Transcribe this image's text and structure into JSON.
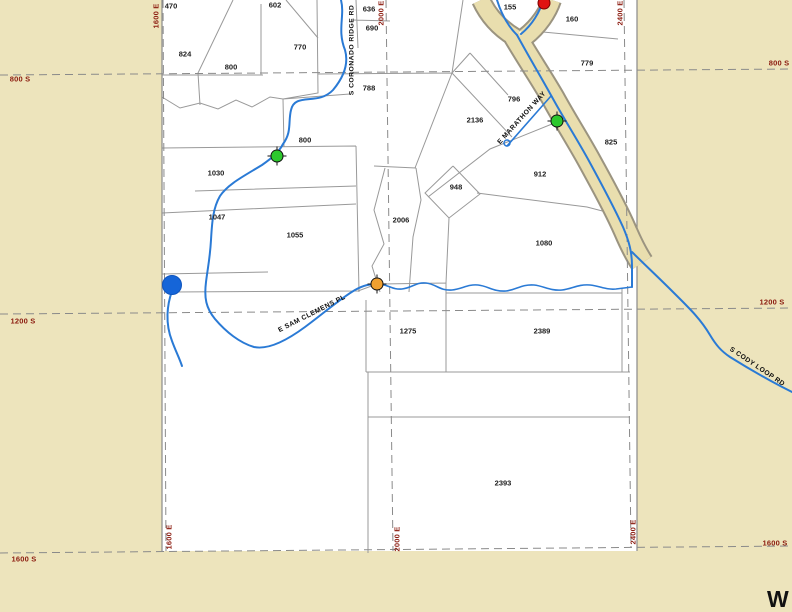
{
  "map": {
    "colors": {
      "background_tan": "#EDE4BC",
      "parcel_area_white": "#FFFFFF",
      "grid_label_red": "#8B1A0E",
      "stream_blue": "#2A7AD5",
      "road_fill_tan": "#E9DEAE",
      "road_casing_gray": "#9B9480",
      "parcel_line_gray": "#999999"
    },
    "compass": {
      "label": "W"
    },
    "grid_labels": [
      {
        "text": "1600 E",
        "x": 156,
        "y": 16,
        "rot": -90,
        "edge": "top"
      },
      {
        "text": "2000 E",
        "x": 381,
        "y": 13,
        "rot": -90,
        "edge": "top"
      },
      {
        "text": "2400 E",
        "x": 620,
        "y": 13,
        "rot": -90,
        "edge": "top"
      },
      {
        "text": "1600 E",
        "x": 169,
        "y": 537,
        "rot": -90,
        "edge": "bottom"
      },
      {
        "text": "2000 E",
        "x": 397,
        "y": 539,
        "rot": -90,
        "edge": "bottom"
      },
      {
        "text": "2400 E",
        "x": 633,
        "y": 532,
        "rot": -90,
        "edge": "bottom"
      },
      {
        "text": "800 S",
        "x": 20,
        "y": 79,
        "rot": 0,
        "edge": "left"
      },
      {
        "text": "1200 S",
        "x": 23,
        "y": 321,
        "rot": 0,
        "edge": "left"
      },
      {
        "text": "1600 S",
        "x": 24,
        "y": 559,
        "rot": 0,
        "edge": "left"
      },
      {
        "text": "800 S",
        "x": 779,
        "y": 63,
        "rot": 0,
        "edge": "right"
      },
      {
        "text": "1200 S",
        "x": 772,
        "y": 302,
        "rot": 0,
        "edge": "right"
      },
      {
        "text": "1600 S",
        "x": 775,
        "y": 543,
        "rot": 0,
        "edge": "right"
      }
    ],
    "road_labels": [
      {
        "text": "S CORONADO RIDGE RD",
        "x": 352,
        "y": 50,
        "rot": -90
      },
      {
        "text": "E MARATHON WAY",
        "x": 522,
        "y": 118,
        "rot": -48
      },
      {
        "text": "E SAM CLEMENS PL",
        "x": 312,
        "y": 314,
        "rot": -27
      },
      {
        "text": "S CODY LOOP RD",
        "x": 757,
        "y": 367,
        "rot": 34
      }
    ],
    "parcels": [
      {
        "label": "470",
        "x": 171,
        "y": 6
      },
      {
        "label": "602",
        "x": 275,
        "y": 5
      },
      {
        "label": "636",
        "x": 369,
        "y": 9
      },
      {
        "label": "690",
        "x": 372,
        "y": 28
      },
      {
        "label": "770",
        "x": 300,
        "y": 47
      },
      {
        "label": "824",
        "x": 185,
        "y": 54
      },
      {
        "label": "800",
        "x": 231,
        "y": 67
      },
      {
        "label": "788",
        "x": 369,
        "y": 88
      },
      {
        "label": "155",
        "x": 510,
        "y": 7
      },
      {
        "label": "160",
        "x": 572,
        "y": 19
      },
      {
        "label": "779",
        "x": 587,
        "y": 63
      },
      {
        "label": "796",
        "x": 514,
        "y": 99
      },
      {
        "label": "2136",
        "x": 475,
        "y": 120
      },
      {
        "label": "825",
        "x": 611,
        "y": 142
      },
      {
        "label": "800",
        "x": 305,
        "y": 140
      },
      {
        "label": "1030",
        "x": 216,
        "y": 173
      },
      {
        "label": "912",
        "x": 540,
        "y": 174
      },
      {
        "label": "948",
        "x": 456,
        "y": 187
      },
      {
        "label": "1047",
        "x": 217,
        "y": 217
      },
      {
        "label": "2006",
        "x": 401,
        "y": 220
      },
      {
        "label": "1055",
        "x": 295,
        "y": 235
      },
      {
        "label": "1080",
        "x": 544,
        "y": 243
      },
      {
        "label": "1275",
        "x": 408,
        "y": 331
      },
      {
        "label": "2389",
        "x": 542,
        "y": 331
      },
      {
        "label": "2393",
        "x": 503,
        "y": 483
      }
    ],
    "markers": [
      {
        "name": "green-crosshair-marker",
        "type": "crosshair",
        "x": 277,
        "y": 156,
        "color": "#2DC82D"
      },
      {
        "name": "green-crosshair-marker",
        "type": "crosshair",
        "x": 557,
        "y": 121,
        "color": "#2DC82D"
      },
      {
        "name": "orange-crosshair-marker",
        "type": "crosshair",
        "x": 377,
        "y": 284,
        "color": "#F0A030"
      },
      {
        "name": "blue-dot-marker",
        "type": "dot",
        "x": 172,
        "y": 285,
        "r": 9,
        "color": "#1565D8",
        "border": "#0F55BE"
      },
      {
        "name": "red-pin-marker",
        "type": "dot",
        "x": 544,
        "y": 3,
        "r": 5.5,
        "color": "#E01212",
        "border": "#7A0000"
      }
    ]
  }
}
